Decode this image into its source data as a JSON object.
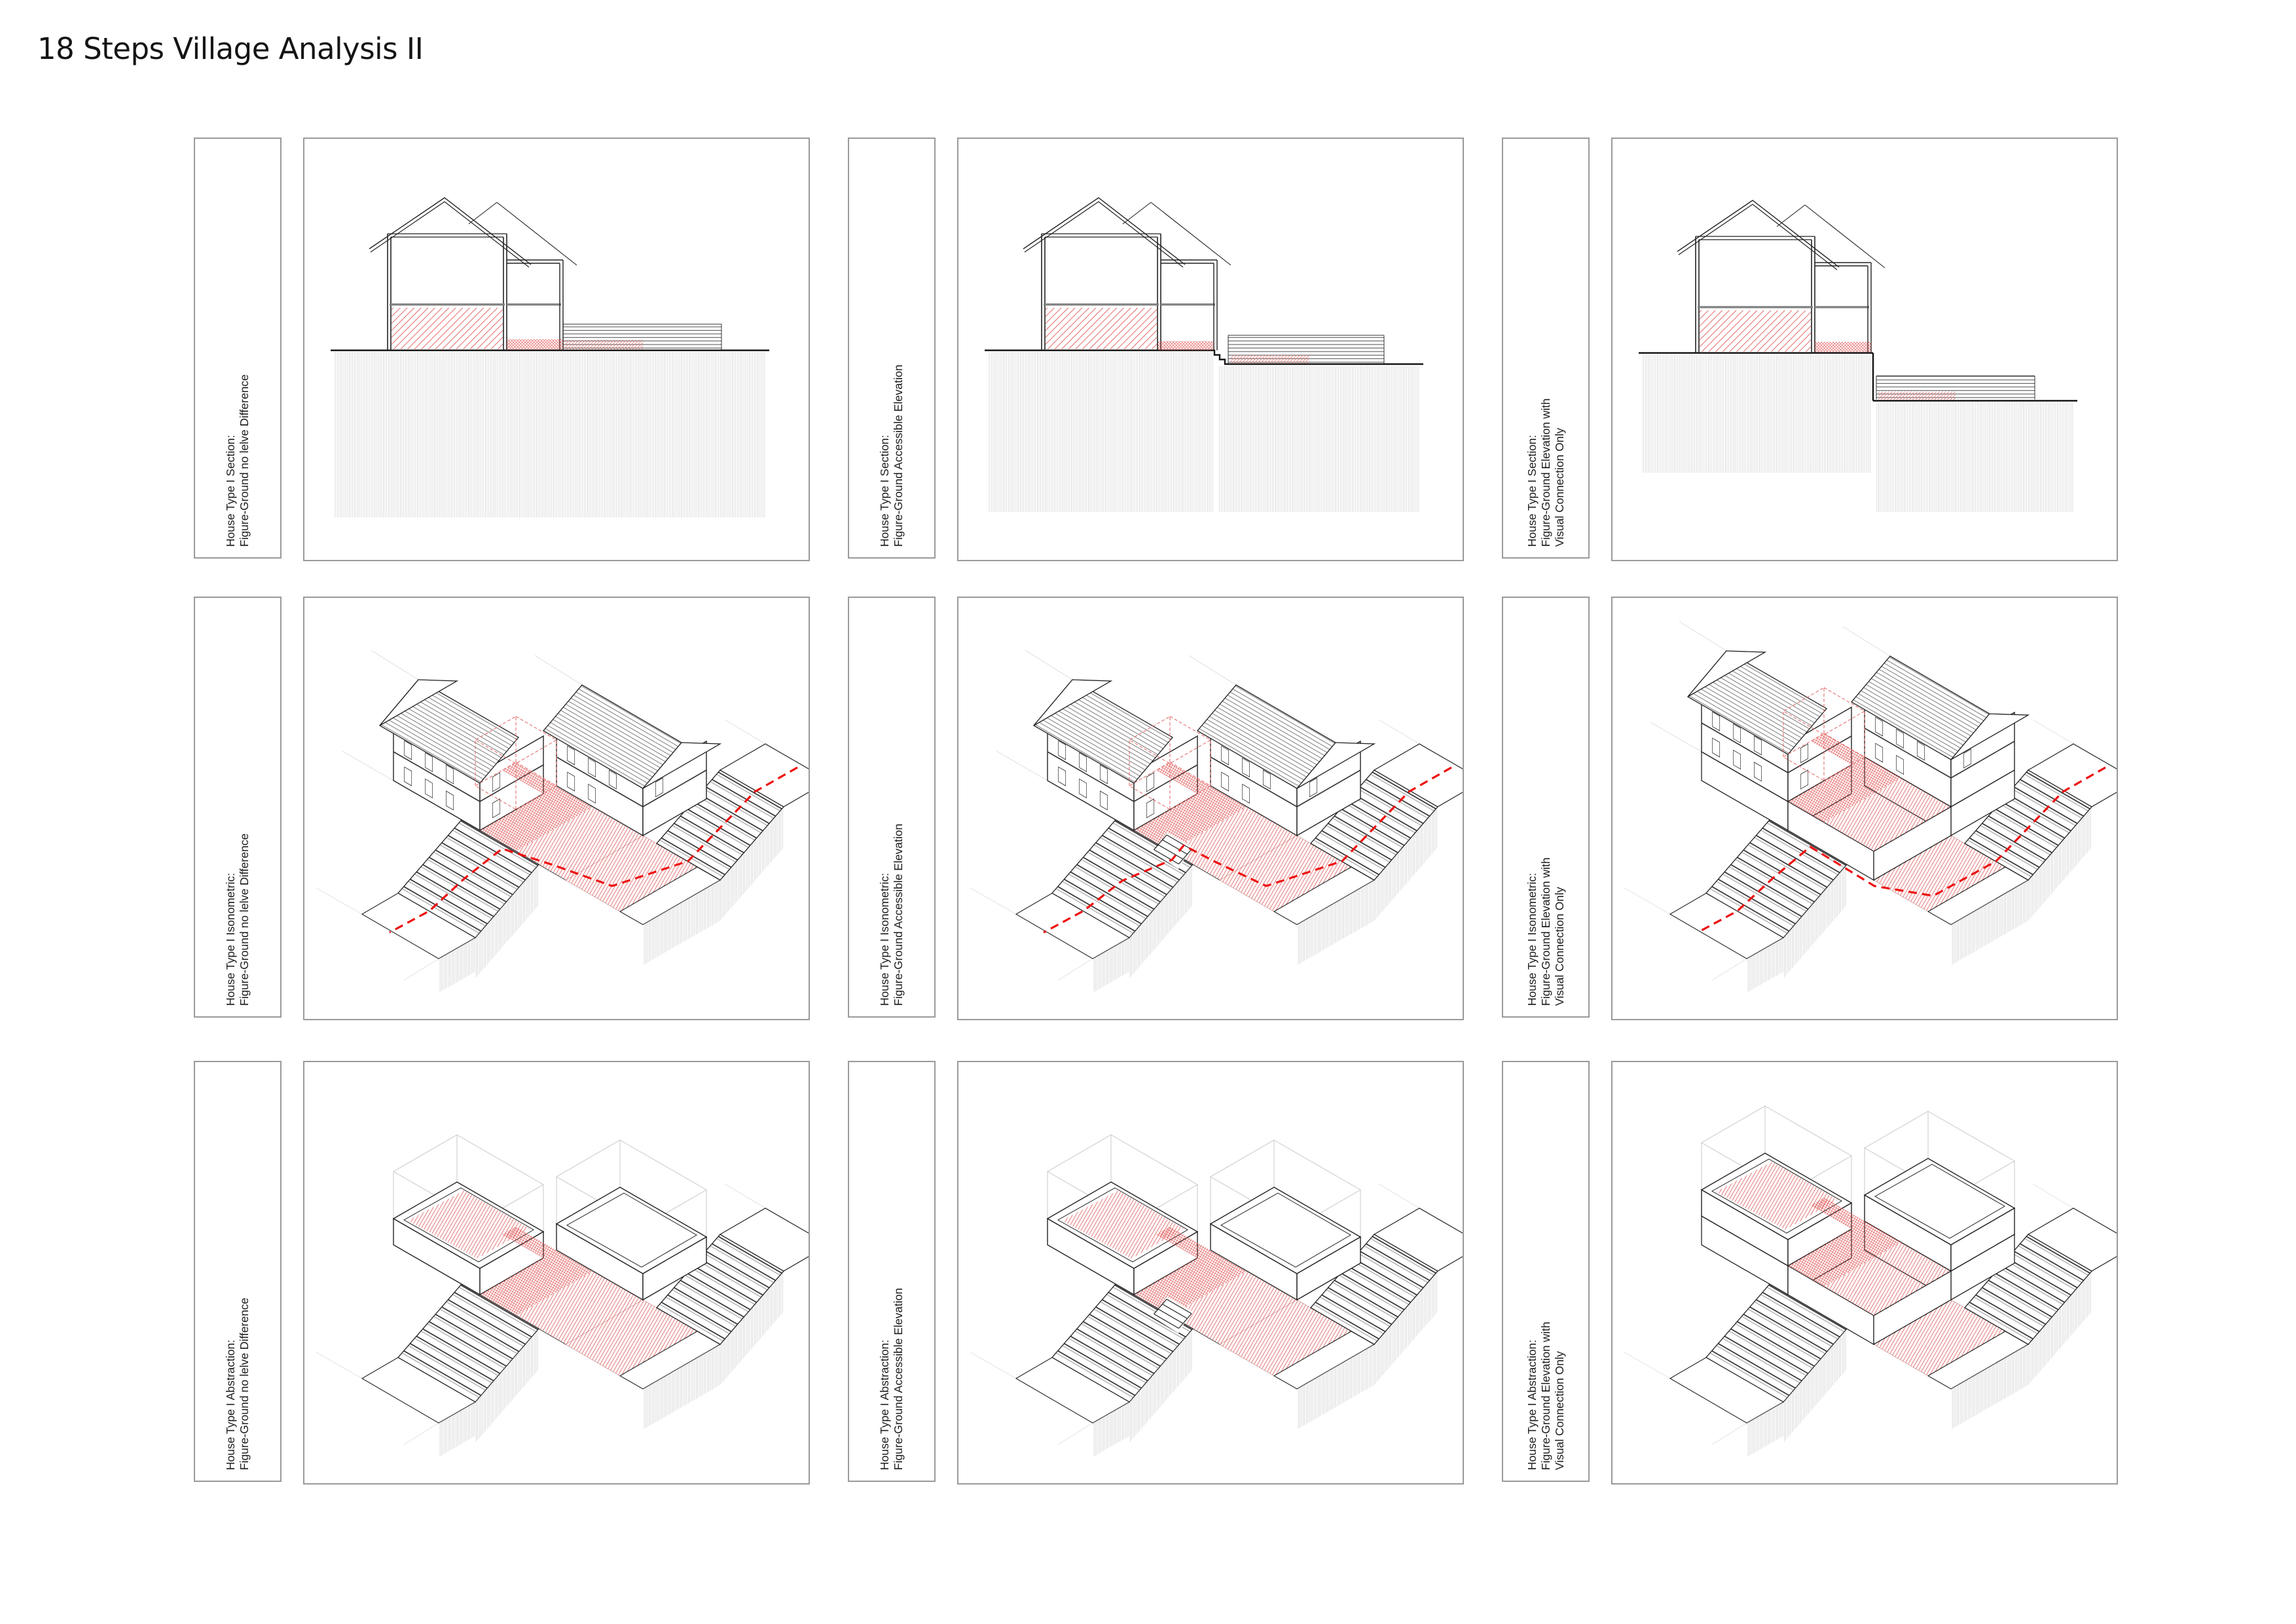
{
  "title": "18 Steps Village Analysis II",
  "colors": {
    "frame_gray": "#9a9a9a",
    "line_black": "#222222",
    "hatch_red": "#e46a6a",
    "path_red": "#ee1111",
    "ground_gray": "#c9c9c9",
    "ghost_gray": "#c8c8c8"
  },
  "panels": [
    {
      "id": "section-no-level",
      "label_lines": [
        "House Type I Section:",
        "Figure-Ground no lelve Difference"
      ]
    },
    {
      "id": "section-accessible",
      "label_lines": [
        "House Type I Section:",
        "Figure-Ground Accessible Elevation"
      ]
    },
    {
      "id": "section-visual-only",
      "label_lines": [
        "House Type I Section:",
        "Figure-Ground Elevation with",
        "Visual Connection Only"
      ]
    },
    {
      "id": "iso-no-level",
      "label_lines": [
        "House Type I Isonometric:",
        "Figure-Ground no lelve Difference"
      ]
    },
    {
      "id": "iso-accessible",
      "label_lines": [
        "House Type I Isonometric:",
        "Figure-Ground Accessible Elevation"
      ]
    },
    {
      "id": "iso-visual-only",
      "label_lines": [
        "House Type I Isonometric:",
        "Figure-Ground Elevation with",
        "Visual Connection Only"
      ]
    },
    {
      "id": "abs-no-level",
      "label_lines": [
        "House Type I Abstraction:",
        "Figure-Ground no lelve Difference"
      ]
    },
    {
      "id": "abs-accessible",
      "label_lines": [
        "House Type I Abstraction:",
        "Figure-Ground Accessible Elevation"
      ]
    },
    {
      "id": "abs-visual-only",
      "label_lines": [
        "House Type I Abstraction:",
        "Figure-Ground Elevation with",
        "Visual Connection Only"
      ]
    }
  ]
}
